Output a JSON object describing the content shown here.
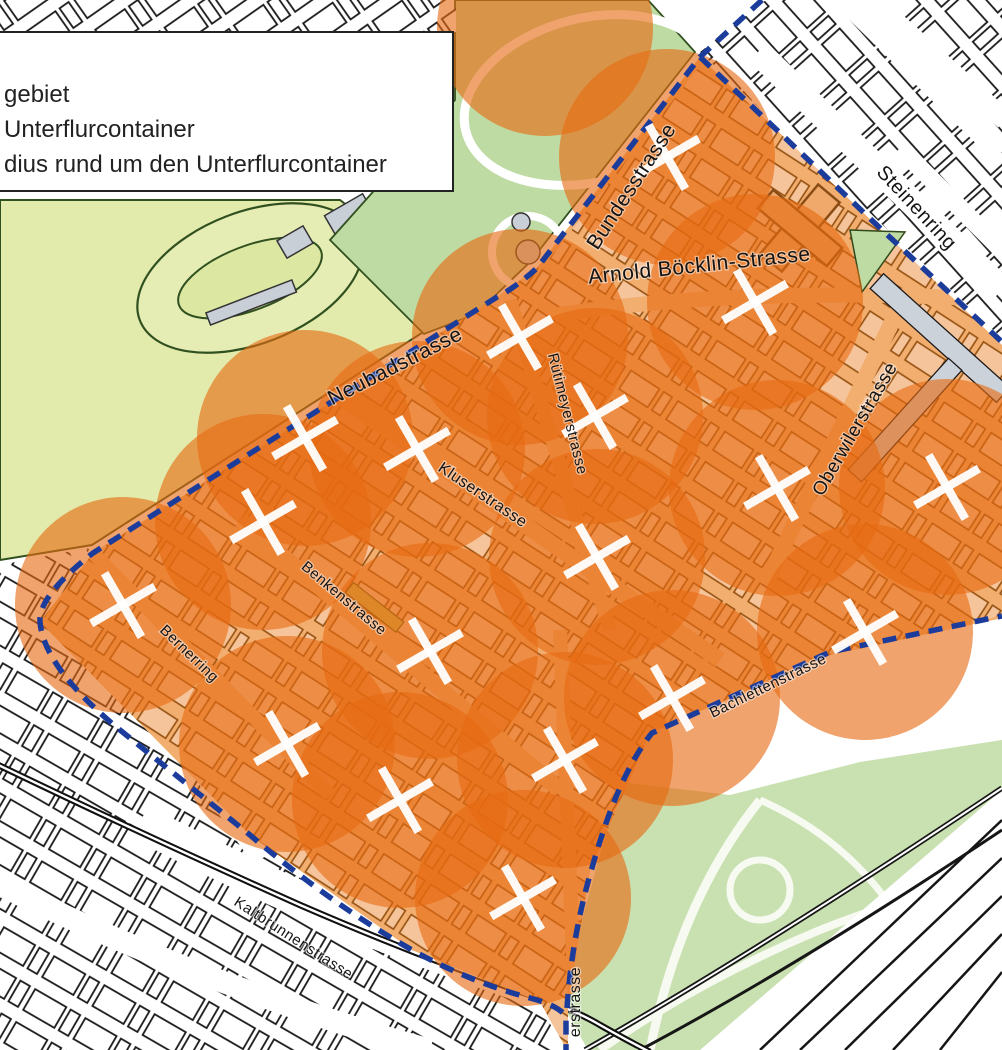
{
  "legend": {
    "lines": [
      "gebiet",
      "Unterflurcontainer",
      "dius rund um den Unterflurcontainer"
    ]
  },
  "map": {
    "colors": {
      "coverage_circle": "#e66a12",
      "boundary_dash_blue": "#1c3c9c",
      "marker_white": "#ffffff",
      "district_street_orange": "#f2ae6f",
      "district_building_salmon": "#f6c49b",
      "park_green": "#bfdba4",
      "field_green": "#e3ebac",
      "zoo_green": "#c9e0b1",
      "grey_building": "#ccd2d9"
    },
    "streets": [
      {
        "name": "Bundesstrasse",
        "x": 637,
        "y": 190,
        "rotate": -57,
        "size": 21
      },
      {
        "name": "Arnold Böcklin-Strasse",
        "x": 700,
        "y": 272,
        "rotate": -6,
        "size": 21
      },
      {
        "name": "Steinenring",
        "x": 912,
        "y": 212,
        "rotate": 47,
        "size": 20
      },
      {
        "name": "Neubadstrasse",
        "x": 398,
        "y": 372,
        "rotate": -27,
        "size": 21
      },
      {
        "name": "Rütimeyerstrasse",
        "x": 563,
        "y": 415,
        "rotate": 76,
        "size": 15
      },
      {
        "name": "Kluserstrasse",
        "x": 480,
        "y": 499,
        "rotate": 34,
        "size": 16
      },
      {
        "name": "Oberwilerstrasse",
        "x": 860,
        "y": 432,
        "rotate": -60,
        "size": 19
      },
      {
        "name": "Benkenstrasse",
        "x": 341,
        "y": 602,
        "rotate": 40,
        "size": 15
      },
      {
        "name": "Bernerring",
        "x": 186,
        "y": 657,
        "rotate": 44,
        "size": 15
      },
      {
        "name": "Bachlettenstrasse",
        "x": 770,
        "y": 690,
        "rotate": -26,
        "size": 15
      },
      {
        "name": "Kaltbrunnenstrasse",
        "x": 291,
        "y": 942,
        "rotate": 33,
        "size": 15
      },
      {
        "name": "erstrasse",
        "x": 580,
        "y": 1002,
        "rotate": -90,
        "size": 16
      }
    ],
    "containers": {
      "radius_px": 108,
      "points": [
        {
          "x": 545,
          "y": 28,
          "marker": false
        },
        {
          "x": 667,
          "y": 157,
          "marker": true
        },
        {
          "x": 755,
          "y": 302,
          "marker": true
        },
        {
          "x": 520,
          "y": 337,
          "marker": true
        },
        {
          "x": 595,
          "y": 416,
          "marker": true
        },
        {
          "x": 305,
          "y": 438,
          "marker": true
        },
        {
          "x": 417,
          "y": 449,
          "marker": true
        },
        {
          "x": 263,
          "y": 522,
          "marker": true
        },
        {
          "x": 777,
          "y": 488,
          "marker": true
        },
        {
          "x": 947,
          "y": 487,
          "marker": true
        },
        {
          "x": 597,
          "y": 557,
          "marker": true
        },
        {
          "x": 123,
          "y": 605,
          "marker": true
        },
        {
          "x": 430,
          "y": 651,
          "marker": true
        },
        {
          "x": 865,
          "y": 632,
          "marker": true
        },
        {
          "x": 672,
          "y": 698,
          "marker": true
        },
        {
          "x": 287,
          "y": 744,
          "marker": true
        },
        {
          "x": 565,
          "y": 760,
          "marker": true
        },
        {
          "x": 400,
          "y": 800,
          "marker": true
        },
        {
          "x": 523,
          "y": 898,
          "marker": true
        }
      ]
    }
  }
}
